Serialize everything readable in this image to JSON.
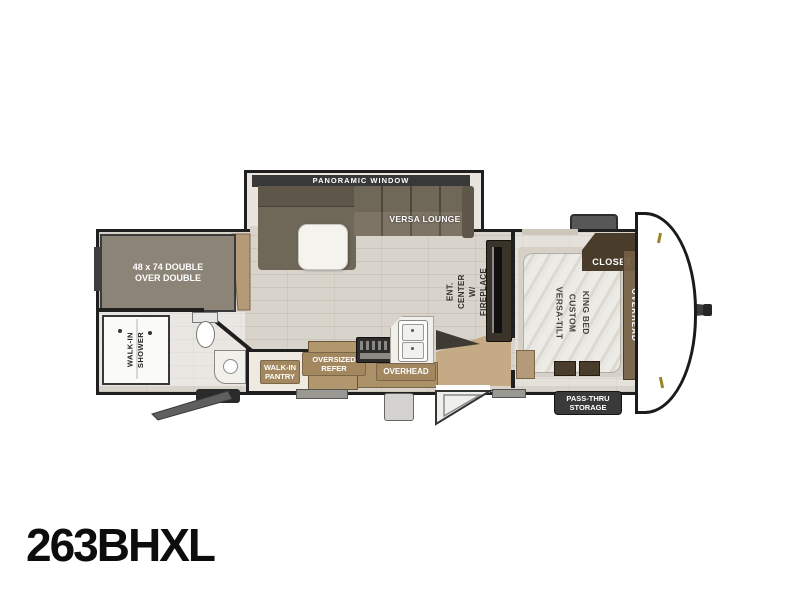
{
  "model_number": "263BHXL",
  "colors": {
    "wall": "#1f1f1f",
    "floor": "#d9d4cb",
    "label_brown": "#a3875f",
    "closet_brown": "#4a3c2b",
    "sofa": "#6f6758",
    "sofa_dark": "#5e5749",
    "bunk_gray": "#8d8478",
    "dark_chip": "#3a3a3a",
    "wood": "#b49a78",
    "mattress": "#e9e7e1"
  },
  "living_area": {
    "panoramic_window_label": "PANORAMIC WINDOW",
    "versa_lounge_label": "VERSA LOUNGE",
    "ent_center_label": [
      "ENT. CENTER",
      "W/ FIREPLACE"
    ],
    "overhead_cabinet_label": "OVERHEAD"
  },
  "kitchen": {
    "oversized_refer_label": [
      "OVERSIZED",
      "REFER"
    ],
    "walk_in_pantry_label": [
      "WALK-IN",
      "PANTRY"
    ]
  },
  "bunk_room": {
    "bunk_bed_label": [
      "48 x 74 DOUBLE",
      "OVER DOUBLE"
    ]
  },
  "bathroom": {
    "walk_in_shower_label": [
      "WALK-IN",
      "SHOWER"
    ]
  },
  "bedroom": {
    "king_bed_label": [
      "VERSA-TILT",
      "CUSTOM",
      "KING BED"
    ],
    "closet_label": "CLOSET",
    "overhead_label": "OVERHEAD"
  },
  "exterior": {
    "pass_thru_storage_label": [
      "PASS-THRU",
      "STORAGE"
    ]
  }
}
